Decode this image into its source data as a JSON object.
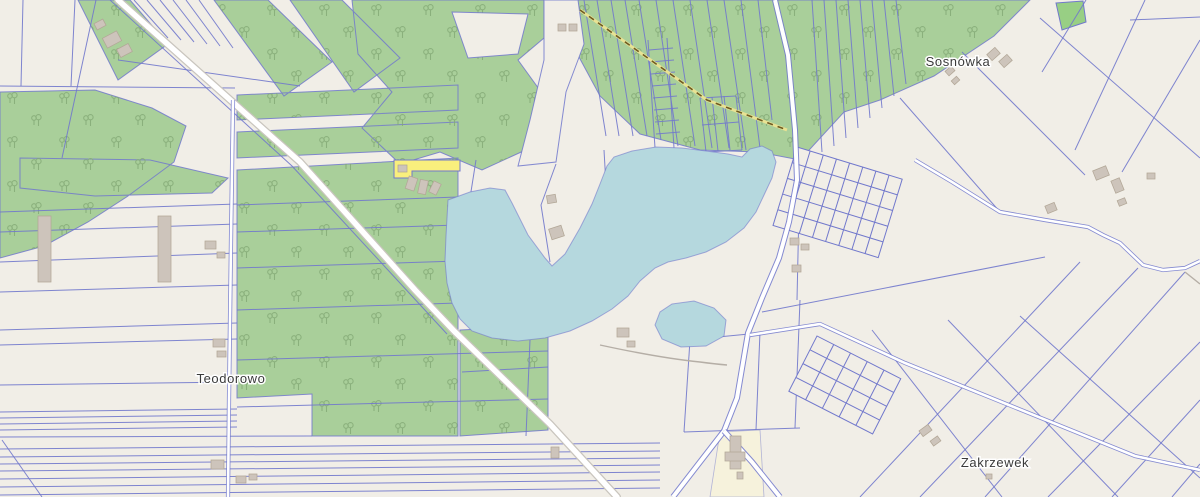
{
  "map": {
    "labels": {
      "place_sosnowka": "Sosnówka",
      "place_teodorowo": "Teodorowo",
      "place_zakrzewek": "Zakrzewek"
    },
    "colors": {
      "land": "#f1eee7",
      "water": "#b5d8de",
      "forest": "#a9cf9a",
      "forest-symbol": "#85ab77",
      "parcel-line": "#7178cc",
      "road-fill": "#ffffff",
      "road-casing": "#c9c5be",
      "track-dash": "#6e5b22",
      "track-base": "#e8e293",
      "highlight-parcel": "#f9ef7d",
      "farmyard": "#f6f2dc",
      "building": "#cdc4bb",
      "building-outline": "#b2a797",
      "label-text": "#3a3a3a",
      "bright-field": "#98cf84"
    }
  }
}
